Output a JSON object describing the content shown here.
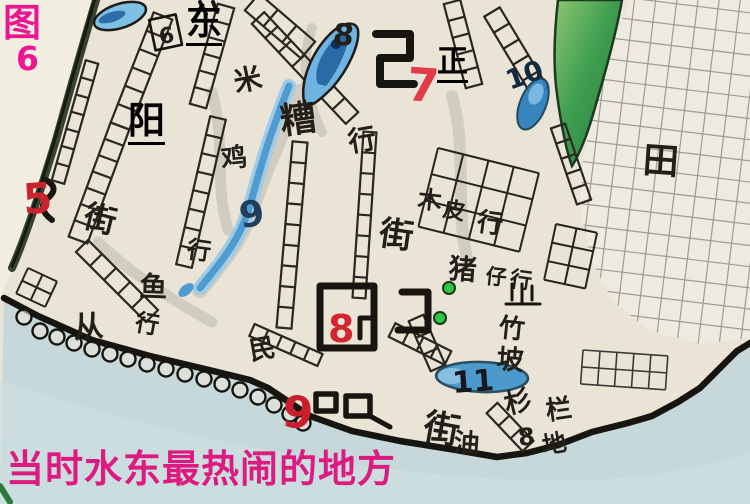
{
  "figure": {
    "char": "图",
    "number": "6"
  },
  "overlays": {
    "east": "东",
    "zheng": "正",
    "yang": "阳"
  },
  "caption": {
    "text": "当时水东最热闹的地方"
  },
  "colors": {
    "figure_magenta": "#ee1590",
    "caption_pink": "#dd1a80",
    "marker_red": "#cc2430",
    "ink_black": "#221f19",
    "pond_blue": "#4f9bd0",
    "water_blue": "#c6d8da",
    "hill_green": "#2f8f46",
    "pencil_grey": "#8f8f88"
  },
  "map": {
    "labels": [
      {
        "id": "num-6",
        "text": "6"
      },
      {
        "id": "num-8-top",
        "text": "8"
      },
      {
        "id": "num-7",
        "text": "7"
      },
      {
        "id": "num-9-stream",
        "text": "9"
      },
      {
        "id": "num-10",
        "text": "10"
      },
      {
        "id": "num-5",
        "text": "5"
      },
      {
        "id": "num-8-market",
        "text": "8"
      },
      {
        "id": "num-9-coast",
        "text": "9"
      },
      {
        "id": "num-11",
        "text": "11"
      },
      {
        "id": "num-8-ground",
        "text": "8"
      },
      {
        "id": "mi",
        "text": "米"
      },
      {
        "id": "zao",
        "text": "糟"
      },
      {
        "id": "hang-mizao",
        "text": "行"
      },
      {
        "id": "ji",
        "text": "鸡"
      },
      {
        "id": "hang-ji",
        "text": "行"
      },
      {
        "id": "jie-left",
        "text": "街"
      },
      {
        "id": "jie-central",
        "text": "街"
      },
      {
        "id": "mu",
        "text": "木"
      },
      {
        "id": "pi",
        "text": "皮"
      },
      {
        "id": "hang-mupi",
        "text": "行"
      },
      {
        "id": "zhu-pig",
        "text": "猪"
      },
      {
        "id": "zai",
        "text": "仔"
      },
      {
        "id": "hang-zhuzai",
        "text": "行"
      },
      {
        "id": "yu",
        "text": "鱼"
      },
      {
        "id": "hang-yu",
        "text": "行"
      },
      {
        "id": "cong",
        "text": "从"
      },
      {
        "id": "min",
        "text": "民"
      },
      {
        "id": "zhu-bamboo",
        "text": "竹"
      },
      {
        "id": "po",
        "text": "坡"
      },
      {
        "id": "shan",
        "text": "杉"
      },
      {
        "id": "lan",
        "text": "栏"
      },
      {
        "id": "jie-bottom",
        "text": "街"
      },
      {
        "id": "you",
        "text": "油"
      },
      {
        "id": "di",
        "text": "地"
      },
      {
        "id": "tian",
        "text": "田"
      }
    ]
  }
}
